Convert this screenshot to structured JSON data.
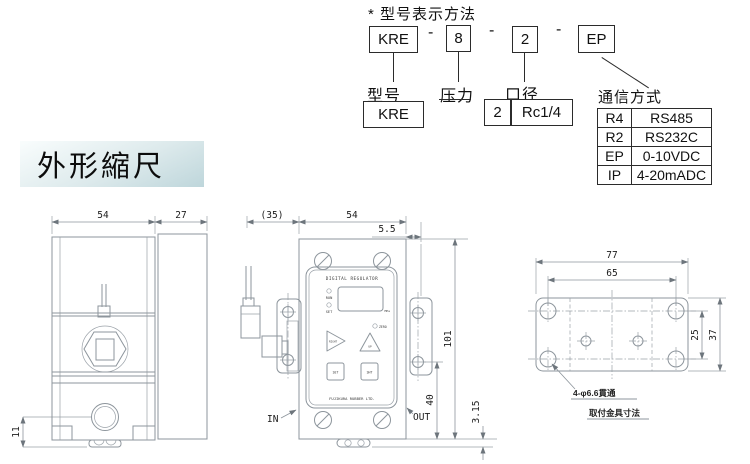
{
  "model_section": {
    "title": "* 型号表示方法",
    "code_boxes": [
      "KRE",
      "8",
      "2",
      "EP"
    ],
    "separators": [
      "-",
      "-",
      "-"
    ],
    "field_labels": [
      "型号",
      "压力",
      "口径",
      "通信方式"
    ],
    "model_box": "KRE",
    "bore_boxes": [
      "2",
      "Rc1/4"
    ],
    "comm_table": {
      "rows": [
        {
          "code": "R4",
          "value": "RS485"
        },
        {
          "code": "R2",
          "value": "RS232C"
        },
        {
          "code": "EP",
          "value": "0-10VDC"
        },
        {
          "code": "IP",
          "value": "4-20mADC"
        }
      ]
    }
  },
  "section_header": {
    "label": "外形縮尺"
  },
  "side_view": {
    "dim_width": "54",
    "dim_depth": "27",
    "dim_port": "11"
  },
  "front_view": {
    "dim_bracket": "(35)",
    "dim_width": "54",
    "dim_flange": "5.5",
    "dim_height": "101",
    "dim_out": "40",
    "dim_foot": "3.15",
    "label_in": "IN",
    "label_out": "OUT",
    "panel_title": "DIGITAL REGULATOR",
    "panel_brand": "FUJIKURA RUBBER LTD.",
    "led_run": "RUN",
    "led_set": "SET",
    "led_zero": "ZERO",
    "unit": "MPa",
    "btn_right": "RIGHT",
    "btn_up": "UP",
    "btn_set": "SET",
    "btn_shift": "SHT"
  },
  "bracket_view": {
    "dim_width": "77",
    "dim_span": "65",
    "dim_pitch": "25",
    "dim_height": "37",
    "hole_note": "4-φ6.6貫通",
    "caption": "取付金具寸法"
  }
}
